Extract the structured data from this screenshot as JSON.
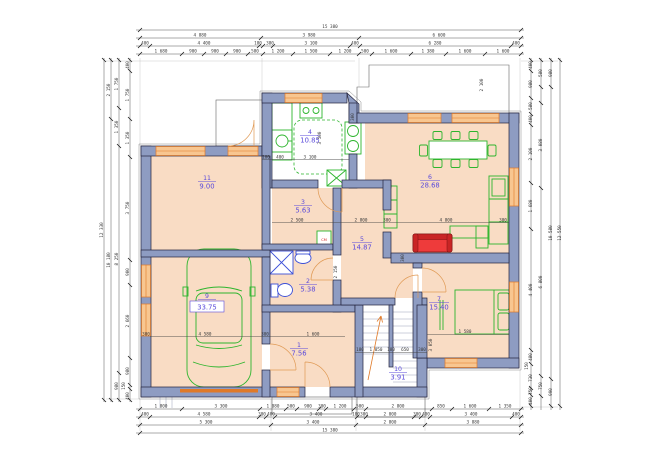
{
  "rooms": [
    {
      "num": "1",
      "area": "7.56"
    },
    {
      "num": "2",
      "area": "5.38"
    },
    {
      "num": "3",
      "area": "5.63"
    },
    {
      "num": "4",
      "area": "10.85"
    },
    {
      "num": "5",
      "area": "14.87"
    },
    {
      "num": "6",
      "area": "28.68"
    },
    {
      "num": "7",
      "area": "15.40"
    },
    {
      "num": "9",
      "area": "33.75"
    },
    {
      "num": "10",
      "area": "3.91"
    },
    {
      "num": "11",
      "area": "9.00"
    }
  ],
  "labels": {
    "boiler": "СМ"
  },
  "dims": {
    "top": {
      "total": "15 380",
      "r2": [
        "4 880",
        "3 980",
        "6 600"
      ],
      "r3": [
        "400",
        "4 400",
        "180",
        "380",
        "3 100",
        "400",
        "6 280",
        "400"
      ],
      "r4": [
        "1 680",
        "900",
        "900",
        "900",
        "580",
        "1 200",
        "1 500",
        "1 200",
        "500",
        "1 600",
        "1 380",
        "1 600",
        "1 600"
      ]
    },
    "bottom": {
      "r1": [
        "1 800",
        "3 300",
        "1 080",
        "500",
        "900",
        "300",
        "1 200",
        "500",
        "2 800",
        "850",
        "1 600",
        "1 350"
      ],
      "r2": [
        "400",
        "4 580",
        "300",
        "400",
        "3 400",
        "100",
        "300",
        "2 000",
        "300",
        "400",
        "3 400",
        "400"
      ],
      "r3": [
        "5 300",
        "3 400",
        "2 800",
        "3 880"
      ],
      "total": "15 380"
    },
    "left": {
      "total": "12 330",
      "c2": [
        "2 150",
        "10 180"
      ],
      "c3": [
        "1 750",
        "1 350",
        "8 250",
        "980"
      ],
      "c4": [
        "400",
        "1 750",
        "1 350",
        "3 750",
        "900",
        "2 660",
        "980",
        "150",
        "400"
      ]
    },
    "right": {
      "total": "12 550",
      "c2": [
        "980",
        "10 580",
        "990"
      ],
      "c3": [
        "580",
        "3 080",
        "6 800",
        "750"
      ],
      "c4": [
        "400",
        "980",
        "580",
        "400",
        "2 100",
        "1 680",
        "4 400",
        "480",
        "150",
        "730",
        "750",
        "400"
      ]
    },
    "inner": [
      "3 100",
      "3 500",
      "400",
      "100",
      "4 580",
      "300",
      "300",
      "2 500",
      "2 800",
      "300",
      "4 800",
      "300",
      "2 150",
      "180",
      "1 050",
      "180",
      "650",
      "300",
      "3 050",
      "1 600",
      "300",
      "300",
      "1 580",
      "2 100"
    ]
  },
  "colors": {
    "wall_fill": "#8e9cc2",
    "wall_stroke": "#23233c",
    "floor": "#f9dcc4",
    "furniture_green": "#2db52d",
    "fixture_blue": "#3b4fd8",
    "window_orange": "#e07a28",
    "sofa_red": "#ee3b3b",
    "label_violet": "#5a4adb",
    "dim_text": "#3a3a3a"
  }
}
